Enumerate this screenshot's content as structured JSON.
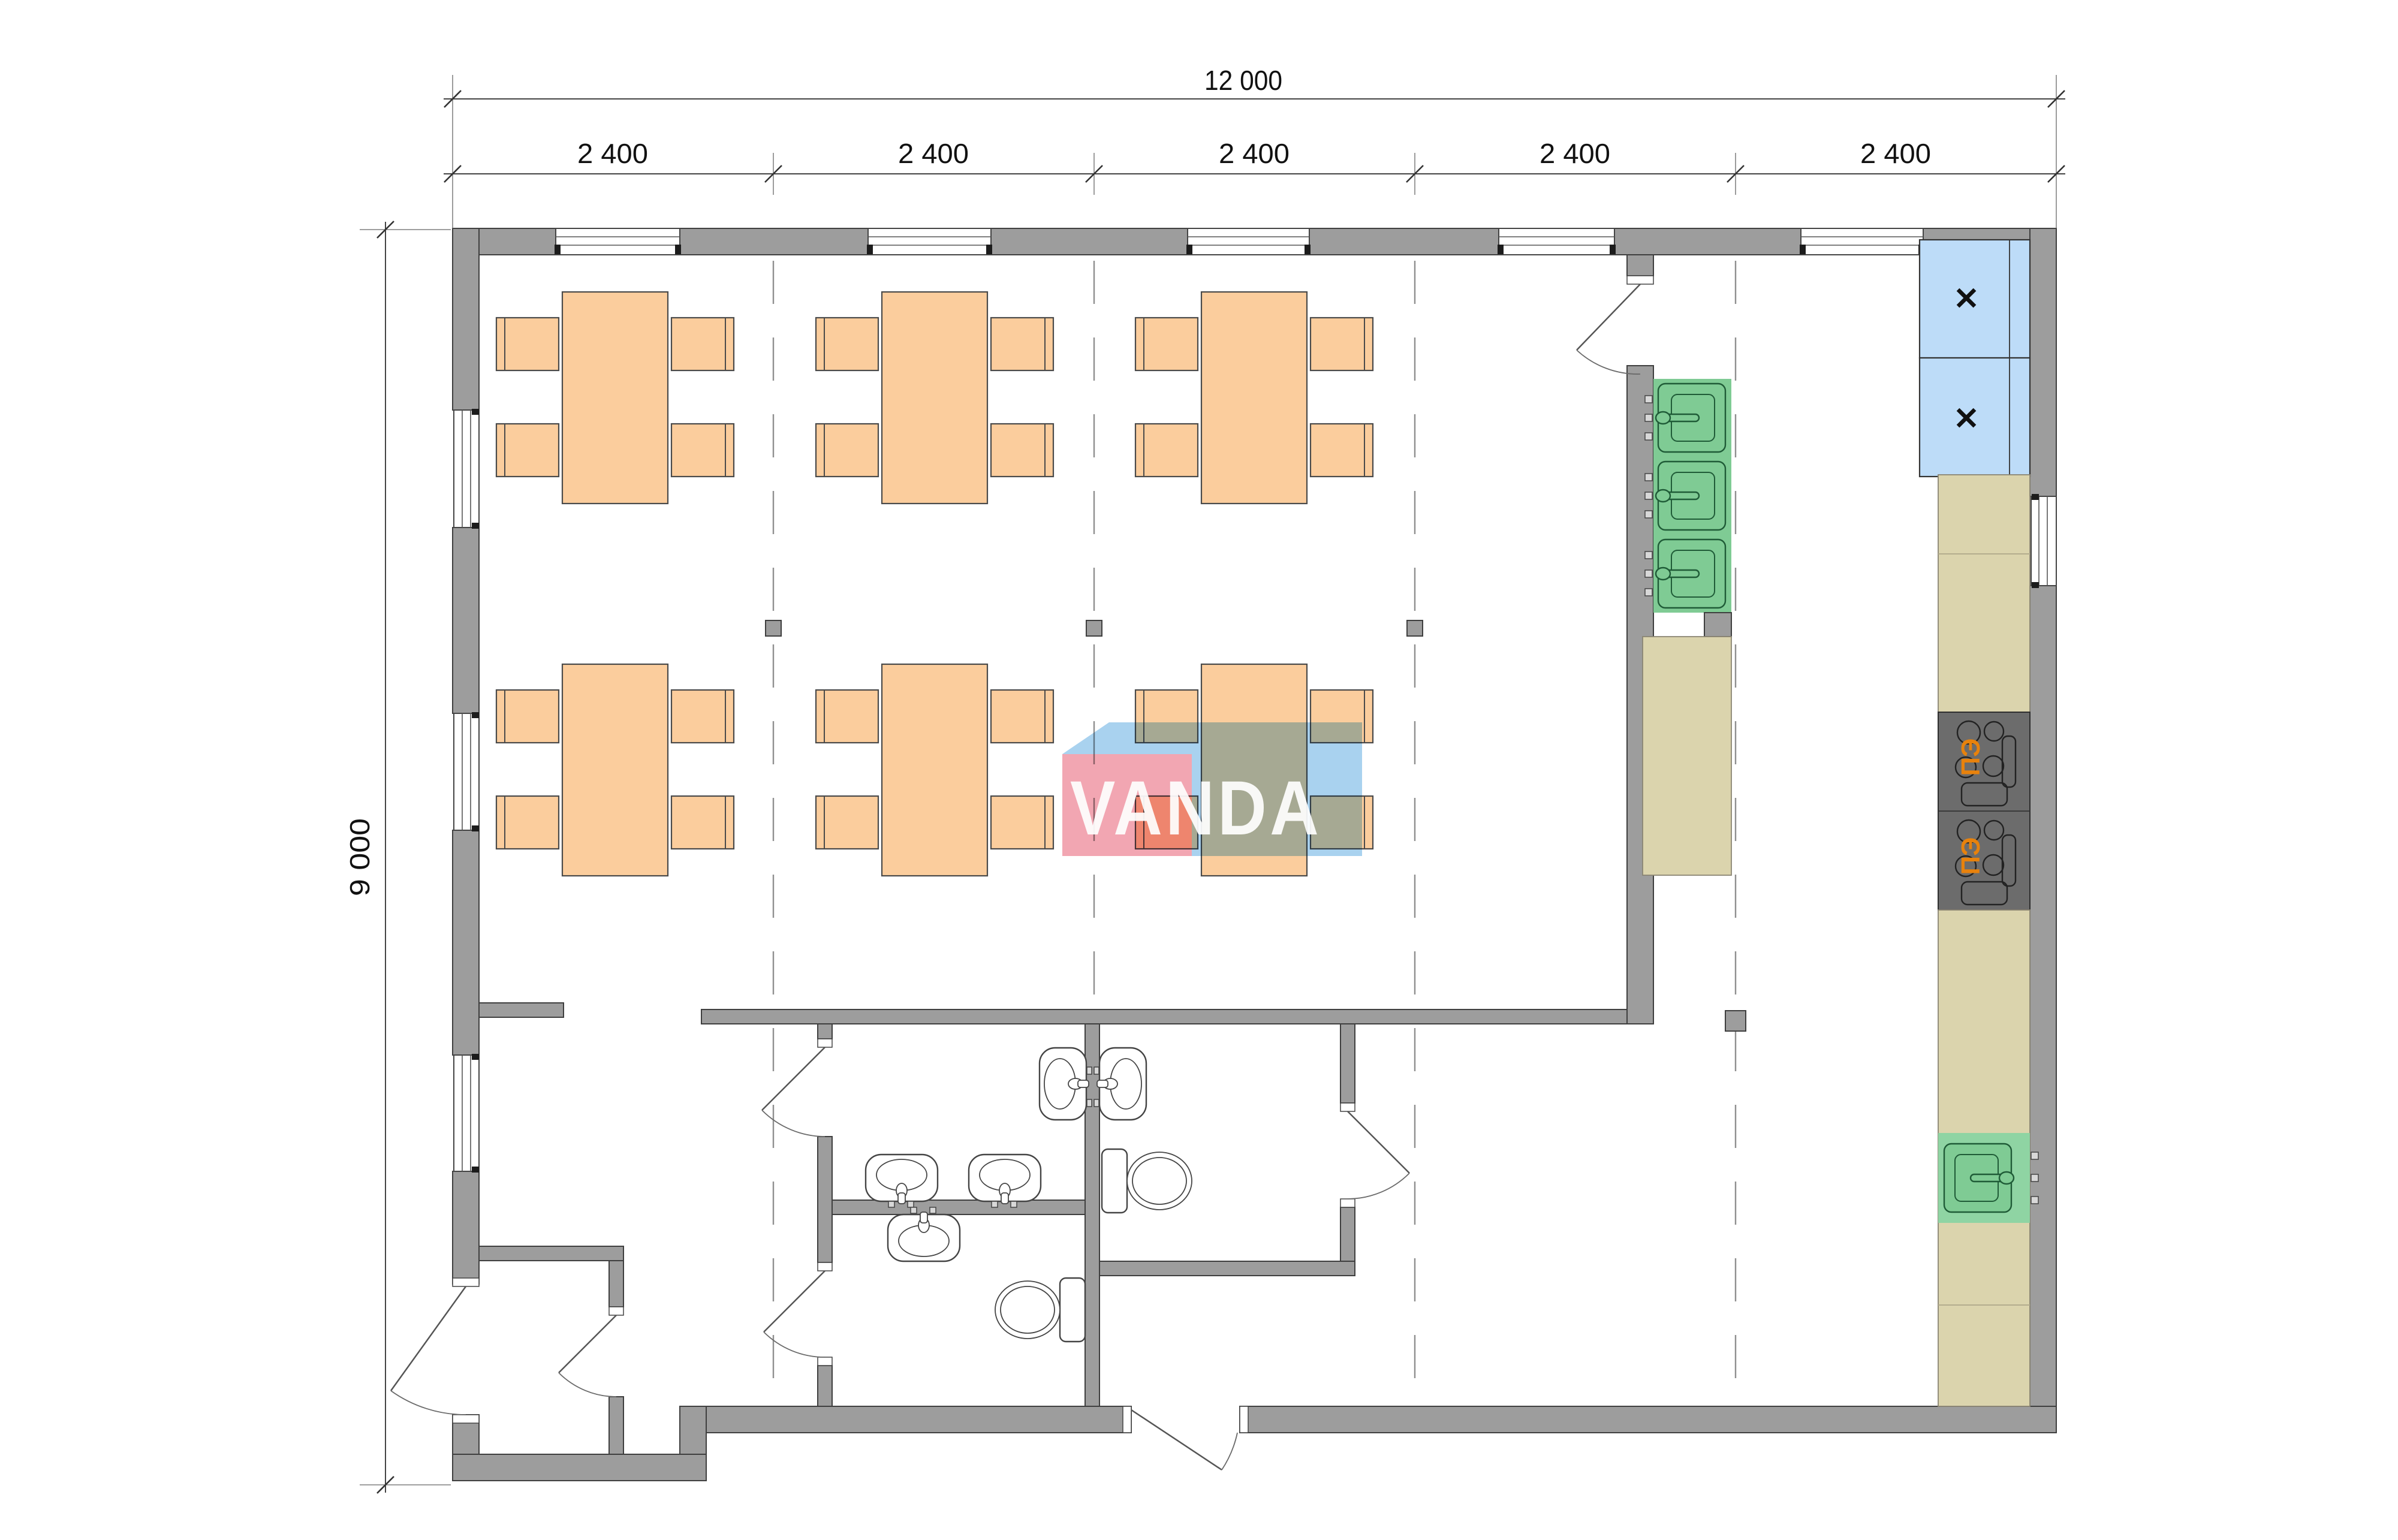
{
  "dimensions": {
    "total": "12 000",
    "modules": [
      "2 400",
      "2 400",
      "2 400",
      "2 400",
      "2 400"
    ],
    "height": "9 000"
  },
  "watermark": {
    "text": "VANDA",
    "pink": "#F2A6B2",
    "blue": "#A9D2EF"
  },
  "equipment": {
    "stove_label": "ПЭ",
    "fridge_mark": "✕"
  },
  "colors": {
    "wall_gray": "#9D9D9D",
    "furniture_orange": "#FBCD9D",
    "fridge_blue": "#BDDCF8",
    "sink_green": "#7FCB94",
    "counter_beige": "#DBD4AD",
    "stove_dark": "#6C6C6C",
    "stove_label_orange": "#E8820C"
  }
}
